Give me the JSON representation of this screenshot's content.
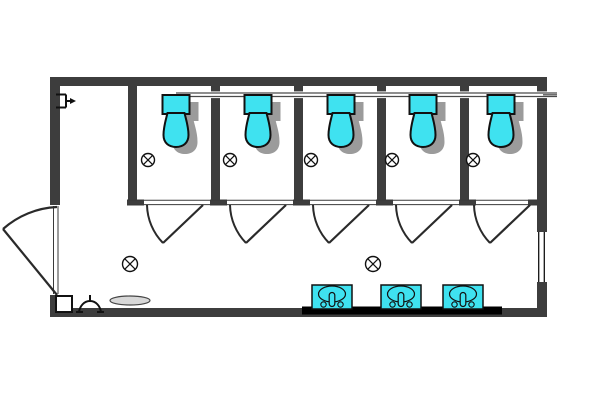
{
  "floor_plan": {
    "description": "restroom-floor-plan",
    "colors": {
      "background": "#ffffff",
      "wall": "#3d3d3d",
      "fixture_fill": "#3fe2f0",
      "outline": "#111111",
      "shadow": "#9b9b9b",
      "counter": "#000000",
      "thin_line": "#3a3a3a",
      "door_line": "#2a2a2a",
      "mat_fill": "#d8d8d8",
      "pipe_line": "#4a4a4a"
    },
    "building": {
      "x": 50,
      "y": 77,
      "width": 497,
      "height": 240,
      "wall_thickness": 10
    },
    "entry_opening": {
      "y1": 205,
      "y2": 295,
      "frame_x1": 53.5,
      "frame_x2": 58
    },
    "entry_door": {
      "hinge": [
        57,
        295
      ],
      "tip": [
        3,
        229
      ],
      "jamb_top": [
        57,
        207
      ],
      "radius": 87
    },
    "window": {
      "x": 537,
      "y": 232,
      "width": 10,
      "height": 50,
      "glass_x1": 538.7,
      "glass_x2": 544.3
    },
    "stalls": {
      "count": 5,
      "partition_x": [
        128,
        211,
        294,
        377,
        460
      ],
      "partition_width": 9,
      "partition_top": 86,
      "partition_bottom": 200,
      "front_rail_y1": 200.3,
      "front_rail_y2": 204.6,
      "front_rail_x1": 128,
      "front_rail_x2": 537,
      "stub_height": 6,
      "right_wall_stub_x": 528
    },
    "stall_doors": {
      "door_y": 205,
      "radius": 56,
      "tip_dx": -40,
      "tip_dy": 38,
      "doors": [
        {
          "jamb_x": 147,
          "hinge_x": 203
        },
        {
          "jamb_x": 230,
          "hinge_x": 286
        },
        {
          "jamb_x": 313,
          "hinge_x": 369
        },
        {
          "jamb_x": 396,
          "hinge_x": 452
        },
        {
          "jamb_x": 474,
          "hinge_x": 530
        }
      ]
    },
    "toilets": {
      "count": 5,
      "centers_x": [
        176,
        258,
        341,
        423,
        501
      ],
      "tank_y": 95,
      "tank_width": 27,
      "tank_height": 19,
      "bowl_bottom_y": 147,
      "shadow_offset": [
        9,
        7
      ]
    },
    "supply_pipe": {
      "x_start": 176,
      "x_end": 557,
      "y1": 93,
      "y2": 96.5,
      "stub_x": 543,
      "stub_mid_y": 94.8
    },
    "ceiling_lights": {
      "stall_lights": [
        [
          148,
          160
        ],
        [
          230,
          160
        ],
        [
          311,
          160
        ],
        [
          392,
          160
        ],
        [
          473,
          160
        ]
      ],
      "room_lights": [
        [
          130,
          264
        ],
        [
          373,
          264
        ]
      ],
      "stall_radius": 6.5,
      "room_radius": 7.5
    },
    "counter": {
      "x": 302,
      "y": 306.5,
      "width": 200,
      "height": 8
    },
    "sinks": {
      "count": 3,
      "centers_x": [
        332,
        401,
        463
      ],
      "top_y": 285,
      "width": 40,
      "height": 24
    },
    "accessories": {
      "corner_box": {
        "x": 56,
        "y": 296,
        "size": 16
      },
      "floor_mat": {
        "cx": 130,
        "cy": 300.5,
        "rx": 20,
        "ry": 4.5
      },
      "wall_hook": {
        "cx": 90,
        "base_y": 312
      },
      "wall_bracket": {
        "x": 56,
        "y": 94.5
      }
    }
  }
}
